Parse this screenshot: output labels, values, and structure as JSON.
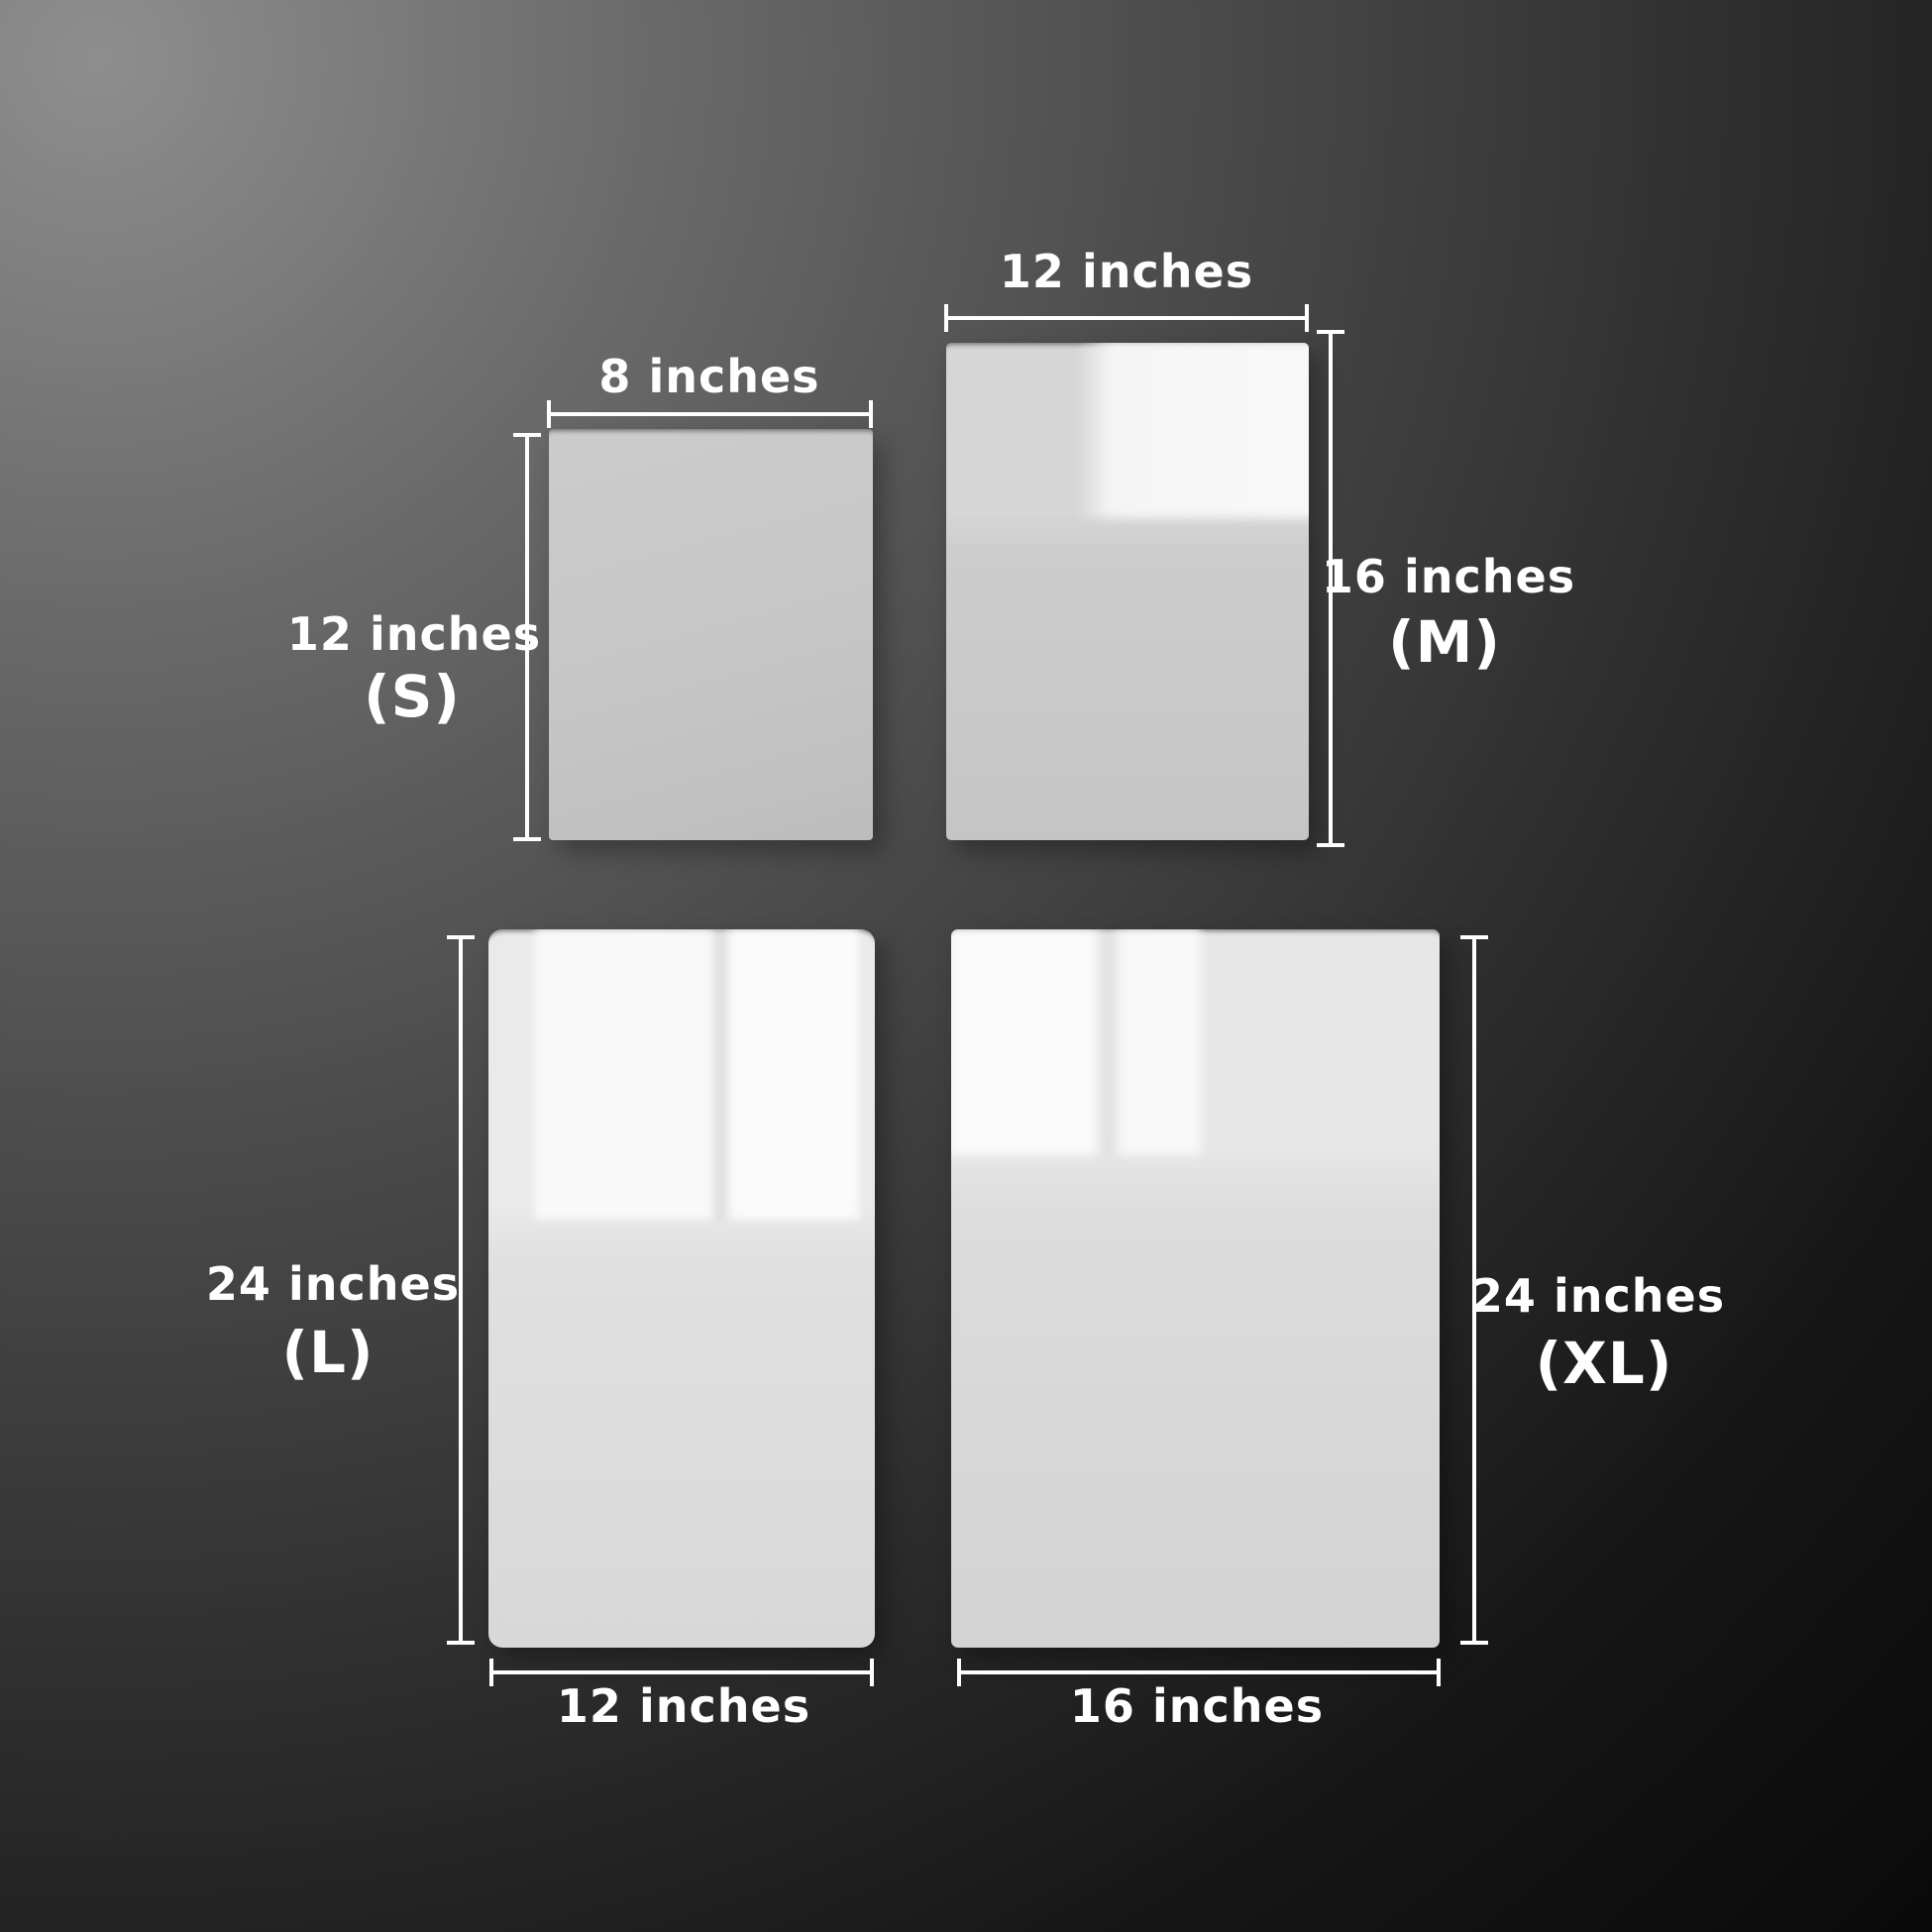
{
  "panels": {
    "s": {
      "size_code": "(S)",
      "width_label": "8 inches",
      "height_label": "12 inches"
    },
    "m": {
      "size_code": "(M)",
      "width_label": "12 inches",
      "height_label": "16 inches"
    },
    "l": {
      "size_code": "(L)",
      "width_label": "12 inches",
      "height_label": "24 inches"
    },
    "xl": {
      "size_code": "(XL)",
      "width_label": "16 inches",
      "height_label": "24 inches"
    }
  },
  "colors": {
    "background_light": "#8e8e8e",
    "background_dark": "#0a0a0a",
    "measure_line": "#ffffff",
    "label_text": "#ffffff",
    "panel_s": "#c6c6c6",
    "panel_m": "#d0d0d0",
    "panel_l": "#e2e2e2",
    "panel_xl": "#dedede"
  }
}
